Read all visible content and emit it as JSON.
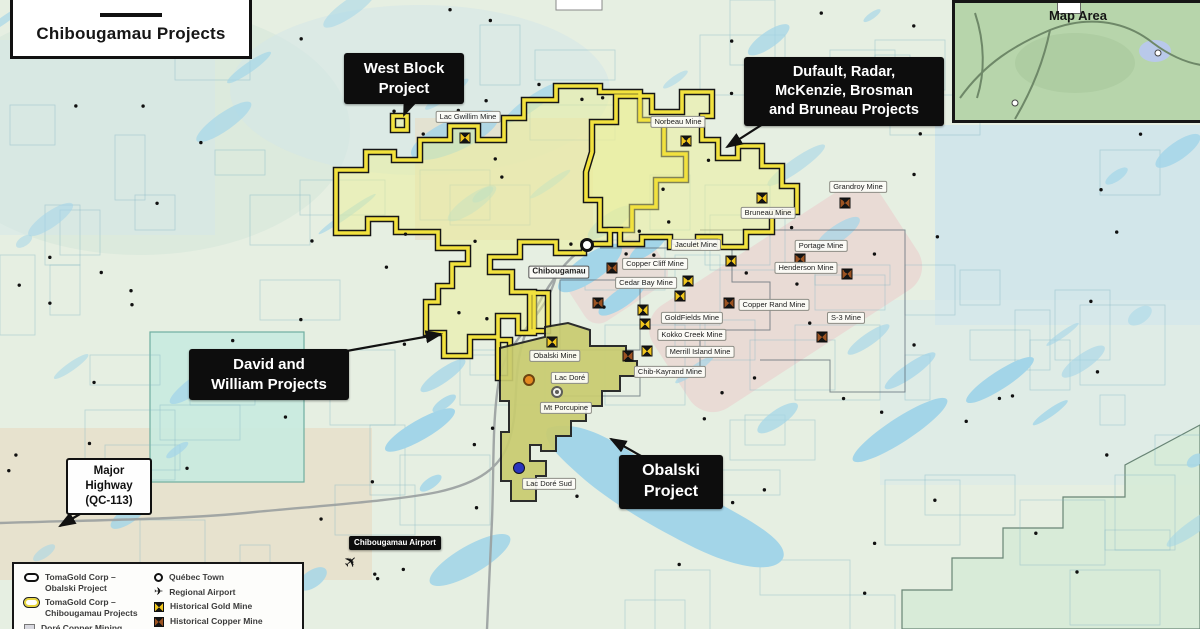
{
  "title": "Chibougamau Projects",
  "inset": {
    "label": "Map Area"
  },
  "town": "Chibougamau",
  "callouts": {
    "west_block": "West Block\nProject",
    "dufault": "Dufault, Radar,\nMcKenzie, Brosman\nand Bruneau Projects",
    "david": "David and\nWilliam Projects",
    "obalski": "Obalski\nProject",
    "highway": "Major\nHighway\n(QC-113)",
    "airport": "Chibougamau Airport"
  },
  "mines": [
    {
      "name": "Lac Gwillim Mine",
      "type": "gold",
      "lx": 468,
      "ly": 117,
      "sx": 465,
      "sy": 138
    },
    {
      "name": "Norbeau Mine",
      "type": "gold",
      "lx": 678,
      "ly": 122,
      "sx": 686,
      "sy": 141
    },
    {
      "name": "Grandroy Mine",
      "type": "copper",
      "lx": 858,
      "ly": 187,
      "sx": 845,
      "sy": 203
    },
    {
      "name": "Bruneau Mine",
      "type": "gold",
      "lx": 768,
      "ly": 213,
      "sx": 762,
      "sy": 198
    },
    {
      "name": "Jaculet Mine",
      "type": "gold",
      "lx": 696,
      "ly": 245,
      "sx": 731,
      "sy": 261
    },
    {
      "name": "Portage Mine",
      "type": "copper",
      "lx": 821,
      "ly": 246,
      "sx": 800,
      "sy": 259
    },
    {
      "name": "Copper Cliff Mine",
      "type": "copper",
      "lx": 655,
      "ly": 264,
      "sx": 612,
      "sy": 268
    },
    {
      "name": "Henderson Mine",
      "type": "copper",
      "lx": 806,
      "ly": 268,
      "sx": 847,
      "sy": 274
    },
    {
      "name": "Cedar Bay Mine",
      "type": "gold",
      "lx": 646,
      "ly": 283,
      "sx": 688,
      "sy": 281
    },
    {
      "name": "Copper Rand Mine",
      "type": "copper",
      "lx": 774,
      "ly": 305,
      "sx": 729,
      "sy": 303
    },
    {
      "name": "GoldFields Mine",
      "type": "gold",
      "lx": 692,
      "ly": 318,
      "sx": 680,
      "sy": 296
    },
    {
      "name": "S-3 Mine",
      "type": "copper",
      "lx": 846,
      "ly": 318,
      "sx": 822,
      "sy": 337
    },
    {
      "name": "Kokko Creek Mine",
      "type": "gold",
      "lx": 692,
      "ly": 335,
      "sx": 645,
      "sy": 324
    },
    {
      "name": "Merrill Island Mine",
      "type": "gold",
      "lx": 700,
      "ly": 352,
      "sx": 647,
      "sy": 351
    },
    {
      "name": "Chib-Kayrand Mine",
      "type": "copper",
      "lx": 670,
      "ly": 372,
      "sx": 628,
      "sy": 356
    },
    {
      "name": "Obalski Mine",
      "type": "gold",
      "lx": 555,
      "ly": 356,
      "sx": 552,
      "sy": 342
    }
  ],
  "extra_symbols": [
    {
      "type": "gold",
      "x": 643,
      "y": 310
    },
    {
      "type": "copper",
      "x": 598,
      "y": 303
    }
  ],
  "features": [
    {
      "name": "Lac Doré",
      "marker": "orange",
      "lx": 570,
      "ly": 378,
      "mx": 529,
      "my": 380
    },
    {
      "name": "Mt Porcupine",
      "marker": "ring",
      "lx": 566,
      "ly": 408,
      "mx": 557,
      "my": 392
    },
    {
      "name": "Lac Doré Sud",
      "marker": "blue",
      "lx": 549,
      "ly": 484,
      "mx": 519,
      "my": 468
    }
  ],
  "town_marker": {
    "x": 587,
    "y": 245
  },
  "airport_marker": {
    "x": 351,
    "y": 562
  },
  "legend": {
    "left": [
      {
        "icon": "outline-black",
        "label": "TomaGold Corp –\nObalski Project"
      },
      {
        "icon": "outline-yellow",
        "label": "TomaGold Corp –\nChibougamau Projects"
      },
      {
        "icon": "square-grey",
        "label": "Doré Copper Mining"
      }
    ],
    "right": [
      {
        "icon": "town",
        "label": "Québec Town"
      },
      {
        "icon": "airport",
        "label": "Regional Airport"
      },
      {
        "icon": "gold",
        "label": "Historical Gold Mine"
      },
      {
        "icon": "copper",
        "label": "Historical Copper Mine"
      }
    ]
  },
  "colors": {
    "base": "#e6efe2",
    "beige": "#e6dfca",
    "pink": "#e9d8d4",
    "teal": "#c9ebe0",
    "paleblue": "#cde4ec",
    "lake": "#a3d5e8",
    "yellow": "#f2e23e",
    "ylfill": "rgba(236,240,150,0.5)",
    "olive": "#c9cc70",
    "grid": "#7fb3c4",
    "road": "#9aa0a0"
  }
}
